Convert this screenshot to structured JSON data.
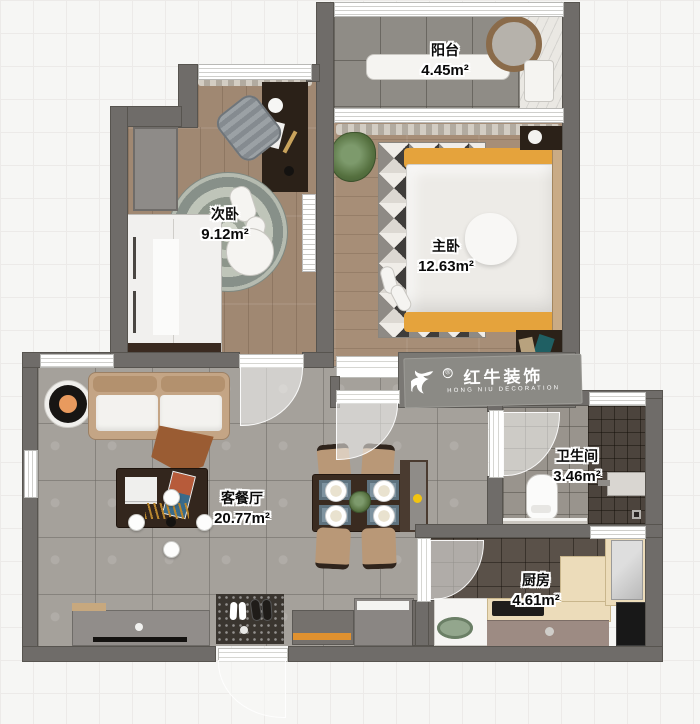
{
  "rooms": [
    {
      "name": "阳台",
      "area": "4.45m²"
    },
    {
      "name": "次卧",
      "area": "9.12m²"
    },
    {
      "name": "主卧",
      "area": "12.63m²"
    },
    {
      "name": "客餐厅",
      "area": "20.77m²"
    },
    {
      "name": "卫生间",
      "area": "3.46m²"
    },
    {
      "name": "厨房",
      "area": "4.61m²"
    }
  ],
  "logo": {
    "name_zh": "红牛装饰",
    "name_en": "HONG NIU DECORATION",
    "registered": "®"
  },
  "colors": {
    "wall": "#6f6c69",
    "wood_floor": "#a08872",
    "gray_tile": "#a5a19b",
    "accent_orange": "#e5a33c",
    "logo_gray": "#8b8a85"
  }
}
